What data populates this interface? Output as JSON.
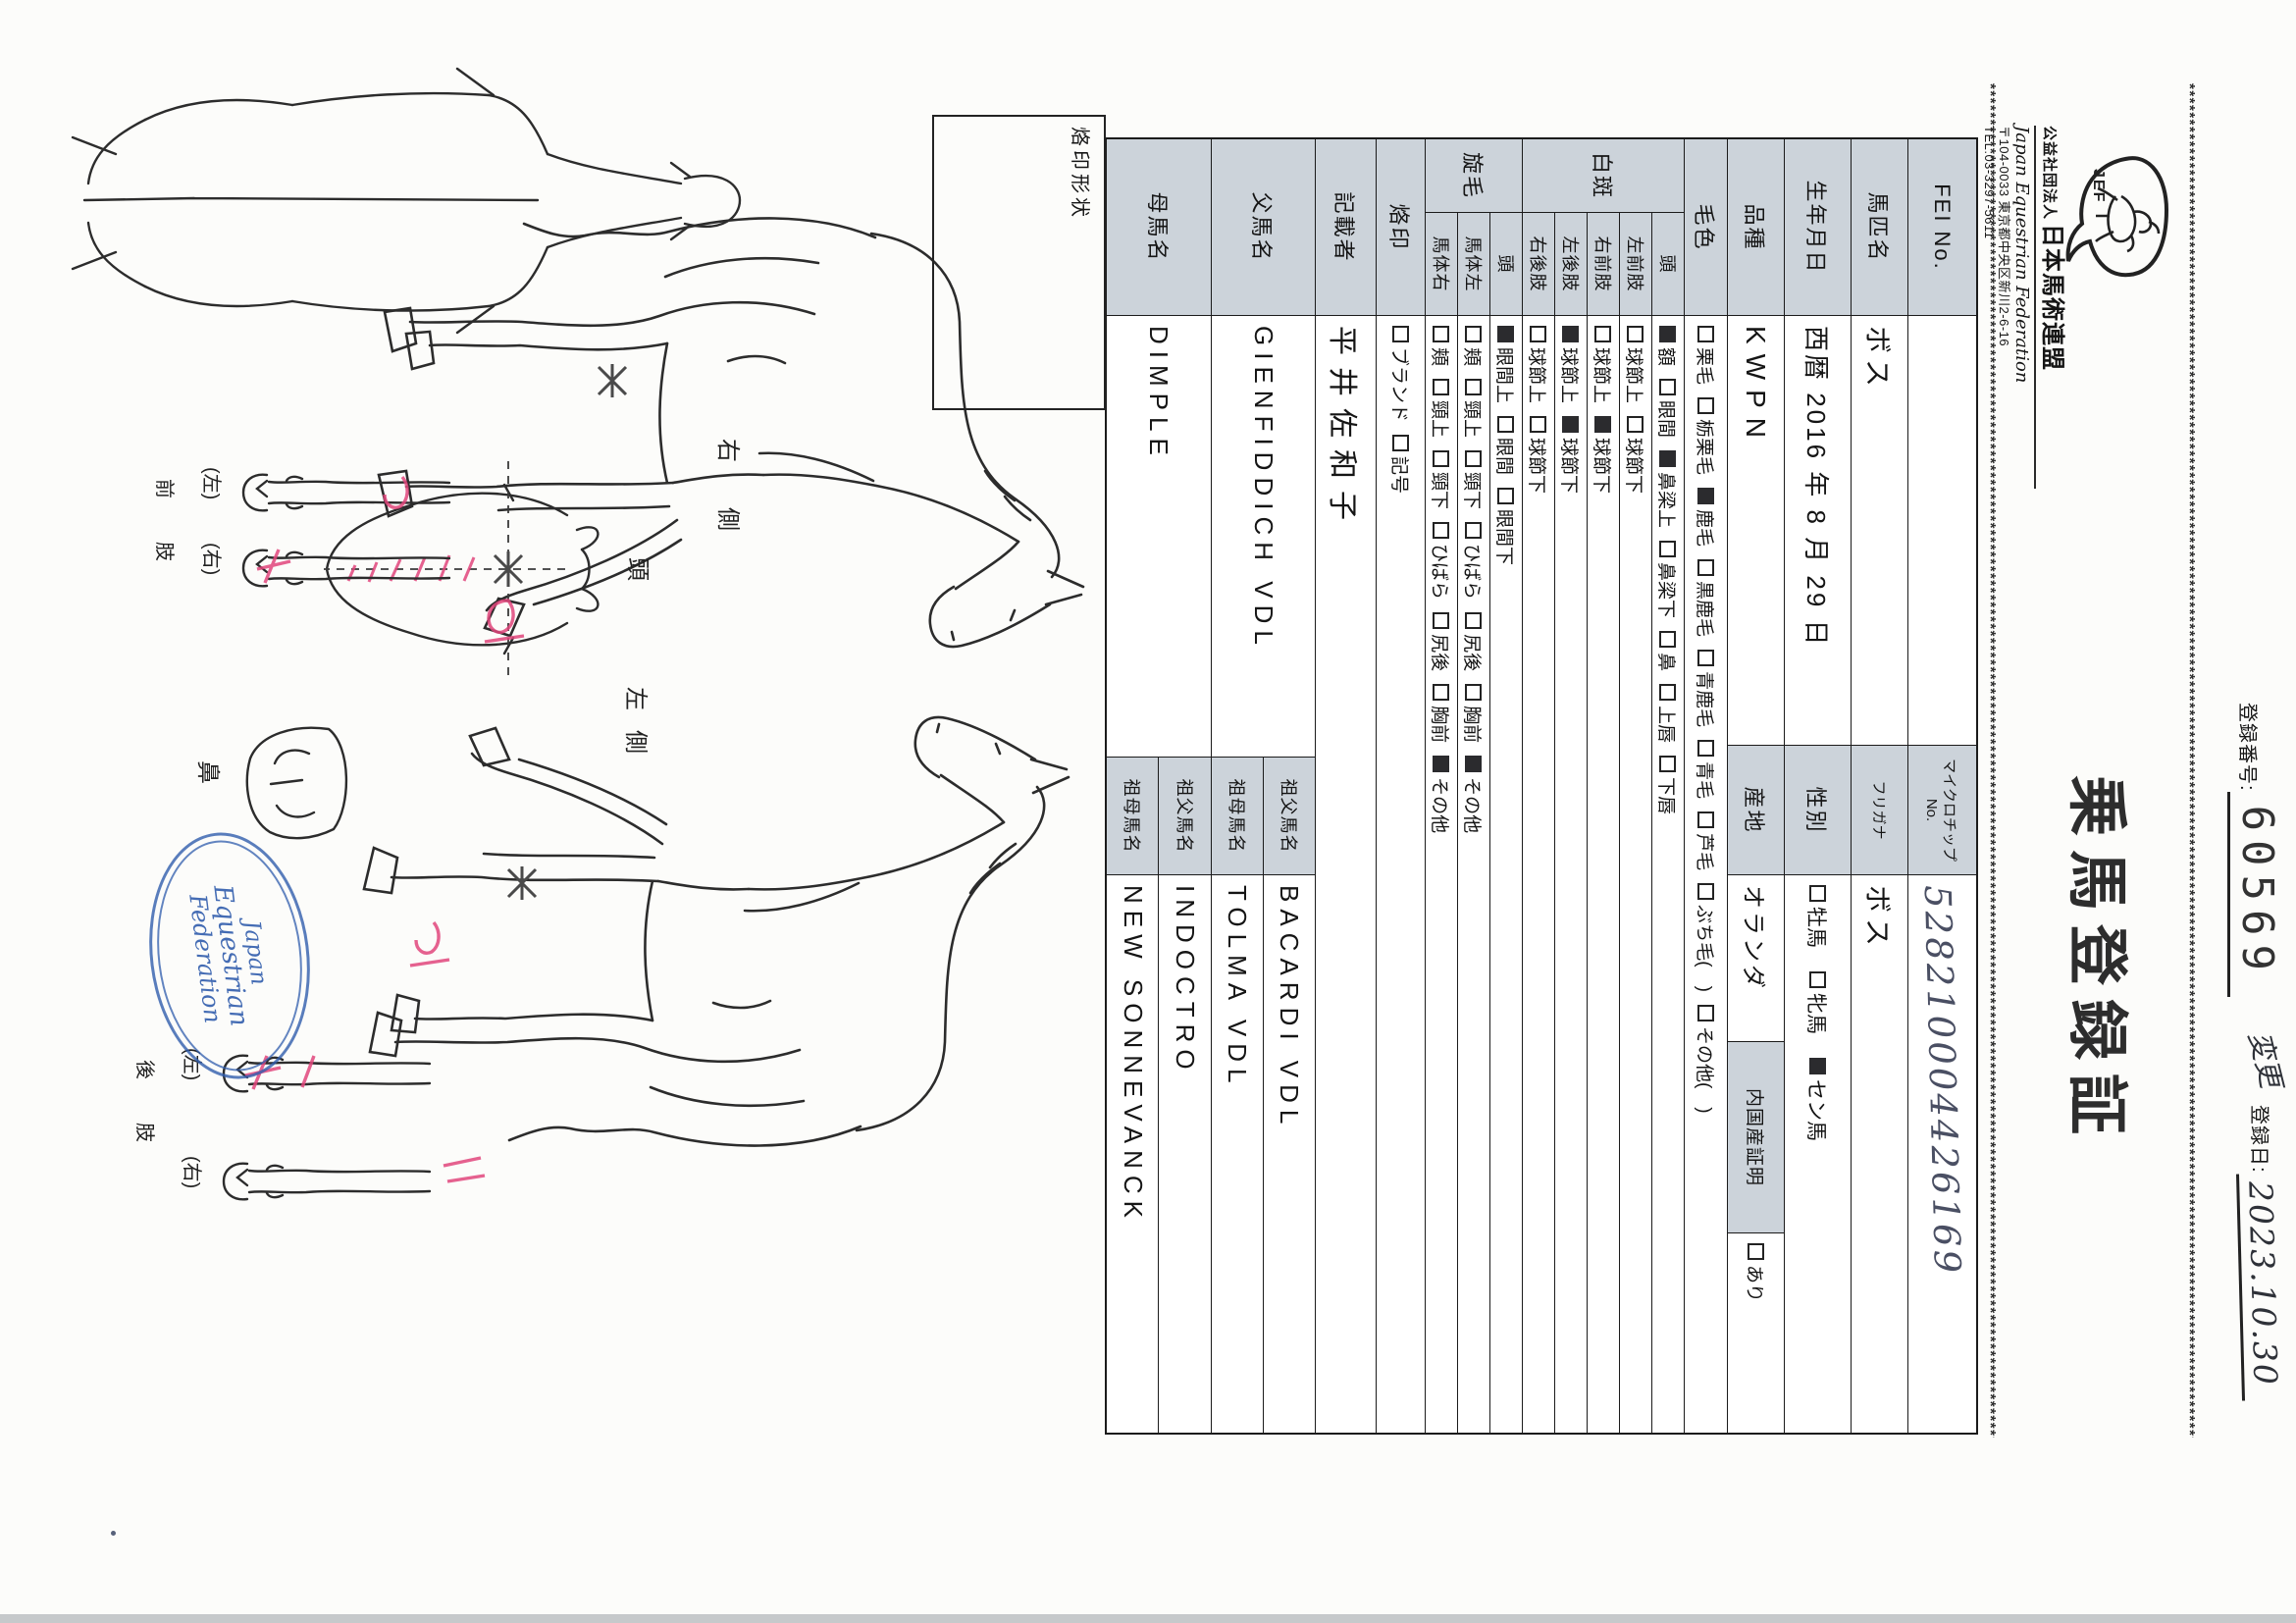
{
  "header": {
    "org_prefix": "公益社団法人",
    "org_name": "日本馬術連盟",
    "org_name_en": "Japan Equestrian Federation",
    "org_address": "〒104-0033 東京都中央区新川2-6-16",
    "org_tel": "TEL:03-3297-5611",
    "logo_text": "JEF",
    "title": "乗馬登録証",
    "reg_no_label": "登録番号:",
    "reg_no": "60569",
    "change_note": "変更",
    "reg_date_label": "登録日:",
    "reg_date": "2023.10.30",
    "border_char": "*"
  },
  "table": {
    "fei_label": "FEI No.",
    "fei_value": "",
    "microchip_label": "マイクロチップNo.",
    "microchip_value": "528210004426169",
    "name_label": "馬匹名",
    "name_value": "ボス",
    "furigana_label": "フリガナ",
    "furigana_value": "ボス",
    "birth_label": "生年月日",
    "birth_value": "西暦 2016 年 8 月 29 日",
    "sex_label": "性別",
    "sex_options": [
      {
        "label": "牡馬",
        "checked": false
      },
      {
        "label": "牝馬",
        "checked": false
      },
      {
        "label": "セン馬",
        "checked": true
      }
    ],
    "breed_label": "品種",
    "breed_value": "KWPN",
    "origin_label": "産地",
    "origin_value": "オランダ",
    "domestic_label": "内国産証明",
    "domestic_options": [
      {
        "label": "あり",
        "checked": false
      }
    ],
    "coat_label": "毛色",
    "coat_options": [
      {
        "label": "栗毛",
        "checked": false
      },
      {
        "label": "栃栗毛",
        "checked": false
      },
      {
        "label": "鹿毛",
        "checked": true
      },
      {
        "label": "黒鹿毛",
        "checked": false
      },
      {
        "label": "青鹿毛",
        "checked": false
      },
      {
        "label": "青毛",
        "checked": false
      },
      {
        "label": "芦毛",
        "checked": false
      },
      {
        "label": "ぶち毛(　)",
        "checked": false
      },
      {
        "label": "その他(　)",
        "checked": false
      }
    ],
    "markings_label": "白斑",
    "markings_rows": [
      {
        "part": "頭",
        "options": [
          {
            "label": "額",
            "checked": true
          },
          {
            "label": "眼間",
            "checked": false
          },
          {
            "label": "鼻梁上",
            "checked": true
          },
          {
            "label": "鼻梁下",
            "checked": false
          },
          {
            "label": "鼻",
            "checked": false
          },
          {
            "label": "上唇",
            "checked": false
          },
          {
            "label": "下唇",
            "checked": false
          }
        ]
      },
      {
        "part": "左前肢",
        "options": [
          {
            "label": "球節上",
            "checked": false
          },
          {
            "label": "球節下",
            "checked": false
          }
        ]
      },
      {
        "part": "右前肢",
        "options": [
          {
            "label": "球節上",
            "checked": false
          },
          {
            "label": "球節下",
            "checked": true
          }
        ]
      },
      {
        "part": "左後肢",
        "options": [
          {
            "label": "球節上",
            "checked": true
          },
          {
            "label": "球節下",
            "checked": true
          }
        ]
      },
      {
        "part": "右後肢",
        "options": [
          {
            "label": "球節上",
            "checked": false
          },
          {
            "label": "球節下",
            "checked": false
          }
        ]
      }
    ],
    "whorls_label": "旋毛",
    "whorls_rows": [
      {
        "part": "頭",
        "options": [
          {
            "label": "眼間上",
            "checked": true
          },
          {
            "label": "眼間",
            "checked": false
          },
          {
            "label": "眼間下",
            "checked": false
          }
        ]
      },
      {
        "part": "馬体左",
        "options": [
          {
            "label": "頬",
            "checked": false
          },
          {
            "label": "頸上",
            "checked": false
          },
          {
            "label": "頸下",
            "checked": false
          },
          {
            "label": "ひばら",
            "checked": false
          },
          {
            "label": "尻後",
            "checked": false
          },
          {
            "label": "胸前",
            "checked": false
          },
          {
            "label": "その他",
            "checked": true
          }
        ]
      },
      {
        "part": "馬体右",
        "options": [
          {
            "label": "頬",
            "checked": false
          },
          {
            "label": "頸上",
            "checked": false
          },
          {
            "label": "頸下",
            "checked": false
          },
          {
            "label": "ひばら",
            "checked": false
          },
          {
            "label": "尻後",
            "checked": false
          },
          {
            "label": "胸前",
            "checked": false
          },
          {
            "label": "その他",
            "checked": true
          }
        ]
      }
    ],
    "brand_label": "烙印",
    "brand_options": [
      {
        "label": "ブランド",
        "checked": false
      },
      {
        "label": "記号",
        "checked": false
      }
    ],
    "recorder_label": "記載者",
    "recorder_value": "平井佐和子",
    "sire_label": "父馬名",
    "sire_value": "GIENFIDDICH VDL",
    "sire_grandsire_label": "祖父馬名",
    "sire_grandsire_value": "BACARDI VDL",
    "sire_granddam_label": "祖母馬名",
    "sire_granddam_value": "TOLMA VDL",
    "dam_label": "母馬名",
    "dam_value": "DIMPLE",
    "dam_grandsire_label": "祖父馬名",
    "dam_grandsire_value": "INDOCTRO",
    "dam_granddam_label": "祖母馬名",
    "dam_granddam_value": "NEW SONNEVANCK"
  },
  "diagram": {
    "brand_box_label": "烙印形状",
    "right_side_label": "右側",
    "left_side_label": "左側",
    "head_label": "頭",
    "nose_label": "鼻",
    "left_paren": "(左)",
    "right_paren": "(右)",
    "forelimb_label": "前肢",
    "hindlimb_label": "後肢",
    "stamp_line1": "Japan",
    "stamp_line2": "Equestrian",
    "stamp_line3": "Federation"
  }
}
